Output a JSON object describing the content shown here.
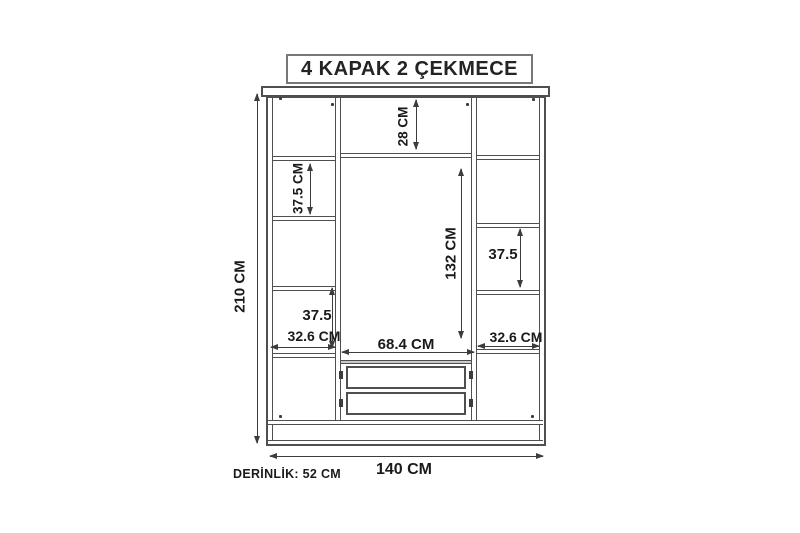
{
  "title": "4 KAPAK 2 ÇEKMECE",
  "overall": {
    "height": "210 CM",
    "width": "140 CM",
    "depth": "DERİNLİK: 52 CM"
  },
  "internal": {
    "top_shelf": "28 CM",
    "left_shelf": "37.5 CM",
    "center_height": "132 CM",
    "right_shelf": "37.5",
    "left_lower": "37.5",
    "left_width": "32.6 CM",
    "center_width": "68.4 CM",
    "right_width": "32.6 CM"
  },
  "colors": {
    "structure_line": "#4f4f4f",
    "dimension_line": "#3c3c3c",
    "text": "#1a1a1a",
    "background": "#ffffff"
  }
}
